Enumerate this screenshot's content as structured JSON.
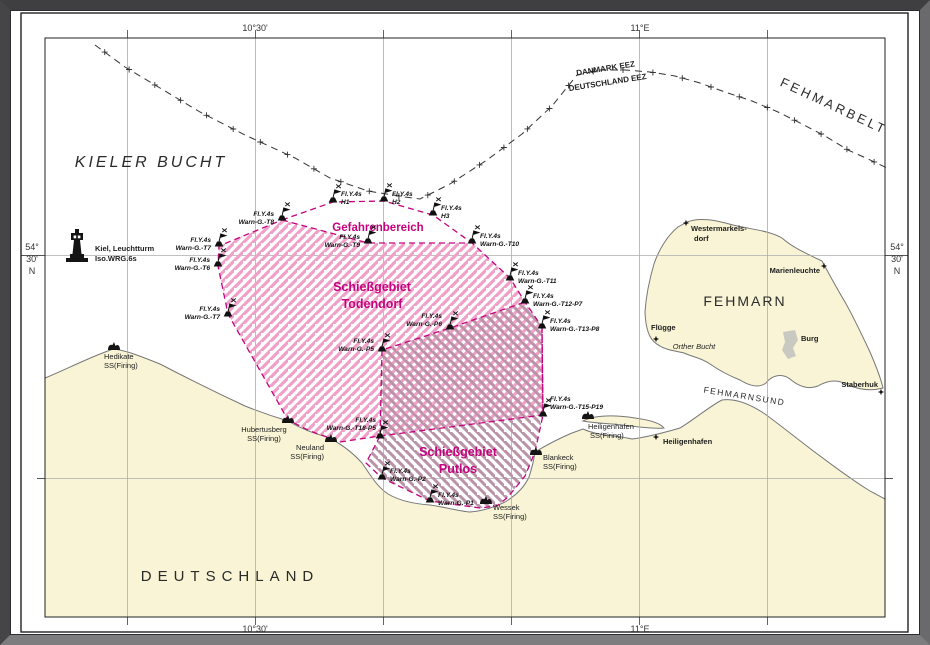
{
  "margin": {
    "top_lon_1": "10°30'",
    "top_lon_2": "11°E",
    "bottom_lon_1": "10°30'",
    "bottom_lon_2": "11°E",
    "left_lat": [
      "54°",
      "30'",
      "N"
    ],
    "right_lat": [
      "54°",
      "30'",
      "N"
    ]
  },
  "sea": {
    "kieler_bucht": "KIELER BUCHT",
    "fehmarbelt": "FEHMARBELT",
    "fehmarnsund": "FEHMARNSUND",
    "fehmarn": "FEHMARN",
    "deutschland": "DEUTSCHLAND",
    "orther_bucht": "Orther Bucht"
  },
  "eez": {
    "danmark": "DANMARK EEZ",
    "deutschland": "DEUTSCHLAND EEZ"
  },
  "areas": {
    "gefahrenbereich": "Gefahrenbereich",
    "todendorf": [
      "Schießgebiet",
      "Todendorf"
    ],
    "putlos": [
      "Schießgebiet",
      "Putlos"
    ]
  },
  "lighthouse": {
    "name": "Kiel, Leuchtturm",
    "char": "Iso.WRG.6s"
  },
  "buoys": [
    {
      "char": "Fl.Y.4s",
      "name": "H1"
    },
    {
      "char": "Fl.Y.4s",
      "name": "H2"
    },
    {
      "char": "Fl.Y.4s",
      "name": "H3"
    },
    {
      "char": "Fl.Y.4s",
      "name": "Warn-G.-T10"
    },
    {
      "char": "Fl.Y.4s",
      "name": "Warn-G.-T9"
    },
    {
      "char": "Fl.Y.4s",
      "name": "Warn-G.-T8"
    },
    {
      "char": "Fl.Y.4s",
      "name": "Warn-G.-T7"
    },
    {
      "char": "Fl.Y.4s",
      "name": "Warn-G.-T6"
    },
    {
      "char": "Fl.Y.4s",
      "name": "Warn-G.-T7"
    },
    {
      "char": "Fl.Y.4s",
      "name": "Warn-G.-T11"
    },
    {
      "char": "Fl.Y.4s",
      "name": "Warn-G.-T12-P7"
    },
    {
      "char": "Fl.Y.4s",
      "name": "Warn-G.-T13-P8"
    },
    {
      "char": "Fl.Y.4s",
      "name": "Warn-G.-P6"
    },
    {
      "char": "Fl.Y.4s",
      "name": "Warn-G.-P5"
    },
    {
      "char": "Fl.Y.4s",
      "name": "Warn-G.-T15-P19"
    },
    {
      "char": "Fl.Y.4s",
      "name": "Warn-G.-T18-P5"
    },
    {
      "char": "Fl.Y.4s",
      "name": "Warn-G.-P2"
    },
    {
      "char": "Fl.Y.4s",
      "name": "Warn-G.-P1"
    }
  ],
  "stations": [
    {
      "name": "Hedikate",
      "type": "SS(Firing)"
    },
    {
      "name": "Hubertusberg",
      "type": "SS(Firing)"
    },
    {
      "name": "Neuland",
      "type": "SS(Firing)"
    },
    {
      "name": "Blankeck",
      "type": "SS(Firing)"
    },
    {
      "name": "Wessek",
      "type": "SS(Firing)"
    },
    {
      "name": "Heiligenhafen",
      "type": "SS(Firing)"
    }
  ],
  "towns": {
    "westermarkelsdorf": [
      "Westermarkels-",
      "dorf"
    ],
    "marienleuchte": "Marienleuchte",
    "fluegge": "Flügge",
    "burg": "Burg",
    "staberhuk": "Staberhuk",
    "heiligenhafen": "Heiligenhafen"
  },
  "colors": {
    "magenta": "#c4047e",
    "land": "#f8f4d5",
    "todendorf_hatch": "#f0a0c8",
    "putlos_hatch": "#bb93a8"
  }
}
